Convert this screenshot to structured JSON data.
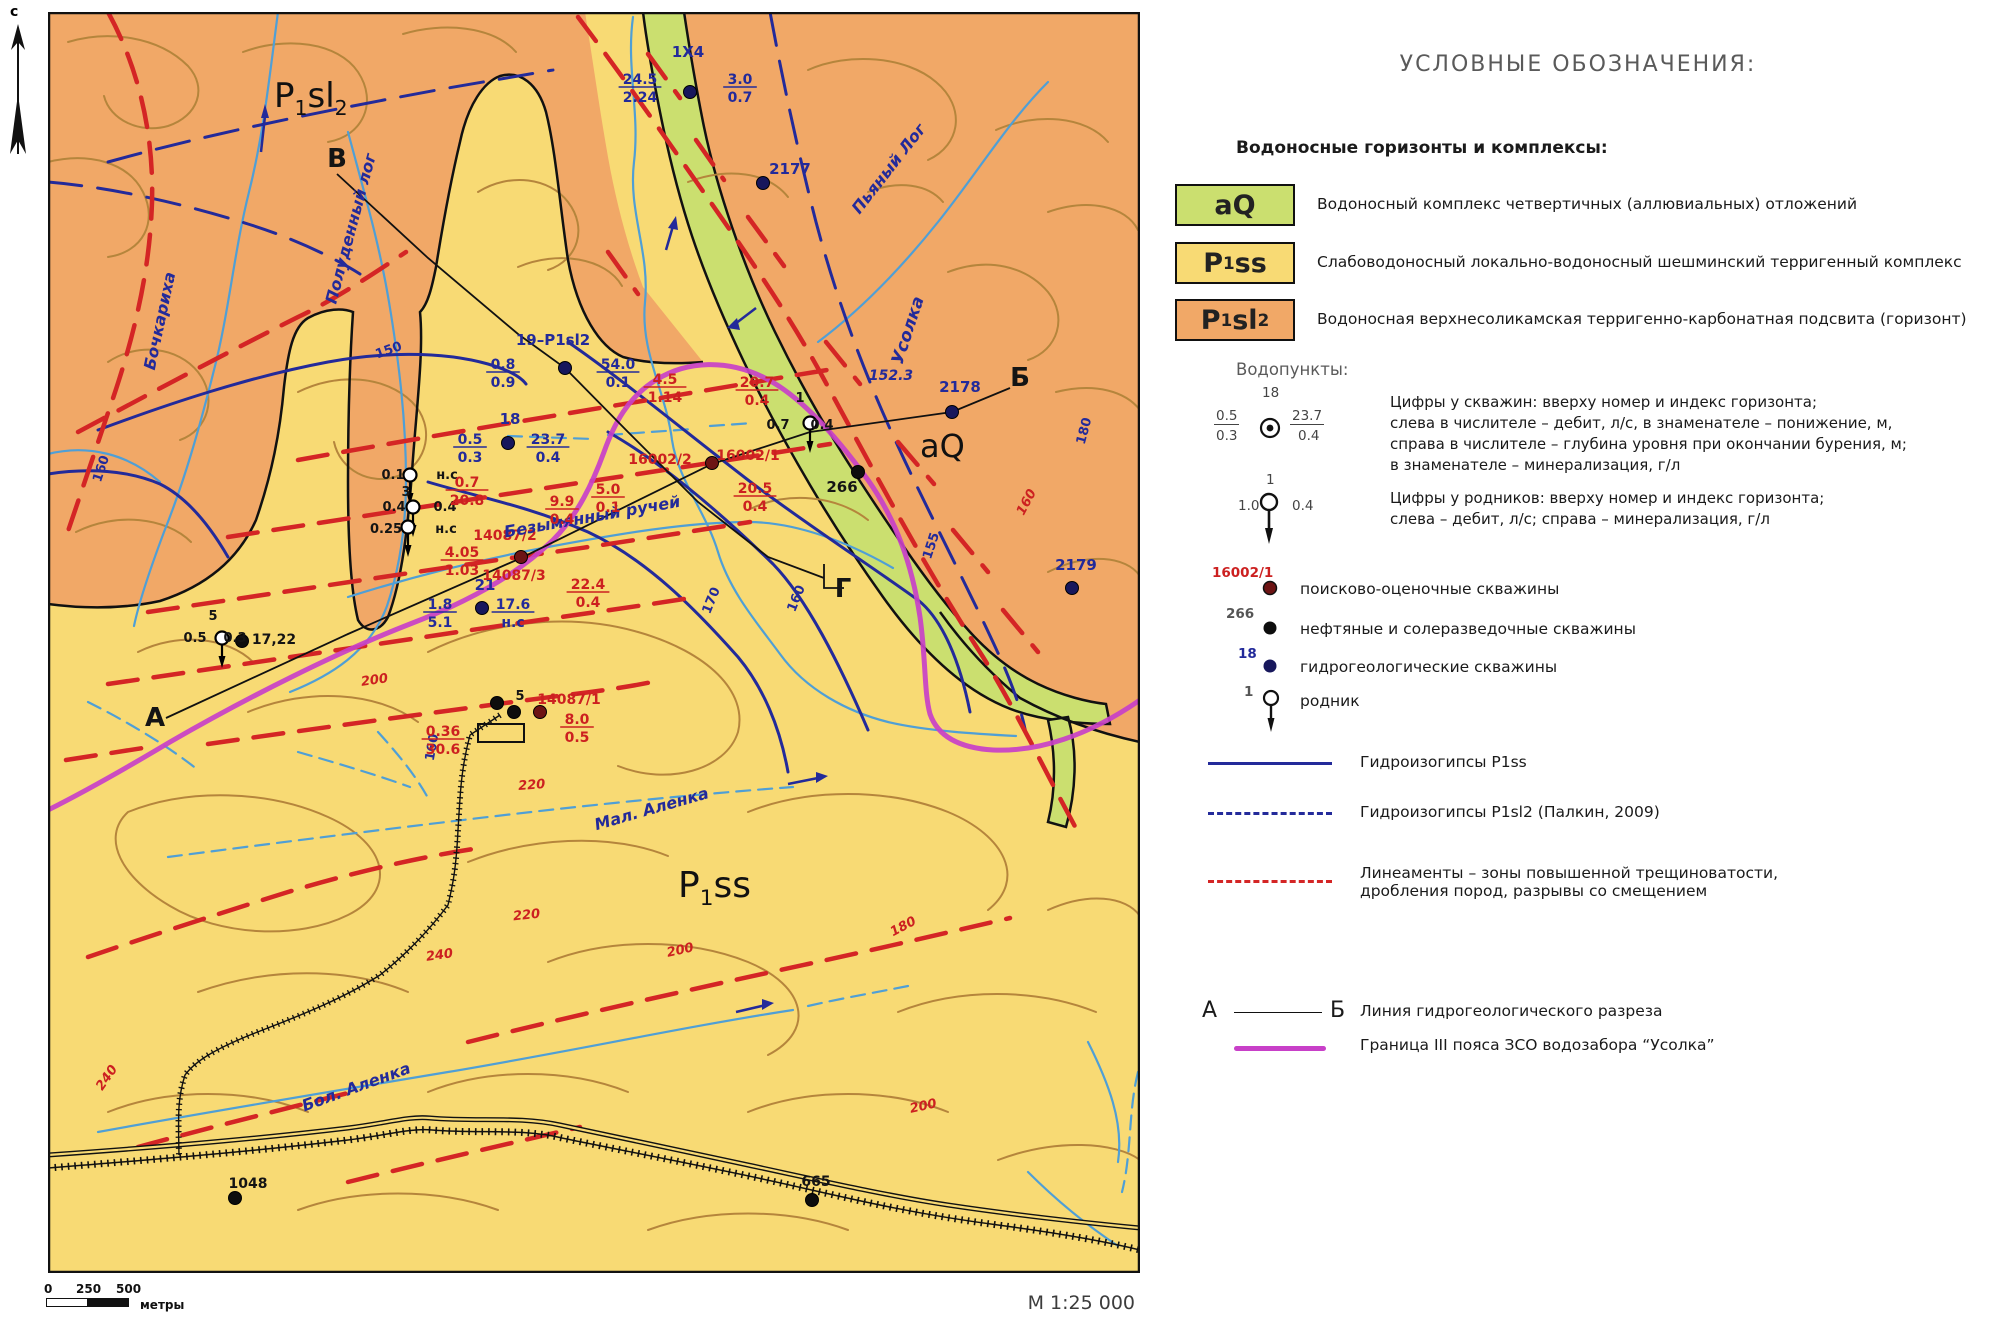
{
  "colors": {
    "aq": "#cbdf6f",
    "p1ss": "#f8da74",
    "p1sl2": "#f1a867",
    "contour": "#b5853c",
    "stream": "#4f9fd6",
    "navy": "#232a9a",
    "black": "#141414",
    "red": "#cc2020",
    "lineament": "#d42525",
    "boundary": "#c840c8",
    "gray": "#555555"
  },
  "page": {
    "north_label": "с",
    "scale_label": "М 1:25 000",
    "scalebar": {
      "t0": "0",
      "t1": "250",
      "t2": "500",
      "unit": "метры"
    }
  },
  "map": {
    "unit_labels": [
      {
        "x": 226,
        "y": 95,
        "size": 34,
        "parts": [
          {
            "t": "P"
          },
          {
            "t": "1",
            "sub": true
          },
          {
            "t": "sl"
          },
          {
            "t": "2",
            "sub": true
          }
        ]
      },
      {
        "x": 630,
        "y": 885,
        "size": 36,
        "parts": [
          {
            "t": "P"
          },
          {
            "t": "1",
            "sub": true
          },
          {
            "t": "ss"
          }
        ]
      },
      {
        "x": 872,
        "y": 445,
        "size": 32,
        "parts": [
          {
            "t": "aQ"
          }
        ]
      }
    ],
    "labels": [
      {
        "t": "1X4",
        "x": 640,
        "y": 45,
        "c": "navy",
        "s": 15
      },
      {
        "t": "2177",
        "x": 742,
        "y": 162,
        "c": "navy",
        "s": 15
      },
      {
        "t": "19–P1sl2",
        "x": 505,
        "y": 333,
        "c": "navy",
        "s": 15
      },
      {
        "t": "18",
        "x": 462,
        "y": 412,
        "c": "navy",
        "s": 15
      },
      {
        "t": "21",
        "x": 437,
        "y": 578,
        "c": "navy",
        "s": 15
      },
      {
        "t": "2178",
        "x": 912,
        "y": 380,
        "c": "navy",
        "s": 15
      },
      {
        "t": "2179",
        "x": 1028,
        "y": 558,
        "c": "navy",
        "s": 15
      },
      {
        "t": "152.3",
        "x": 843,
        "y": 368,
        "c": "navy",
        "s": 14,
        "i": true
      },
      {
        "t": "150",
        "x": 342,
        "y": 342,
        "c": "navy",
        "s": 13,
        "r": -20
      },
      {
        "t": "160",
        "x": 57,
        "y": 458,
        "c": "navy",
        "s": 13,
        "r": -72
      },
      {
        "t": "170",
        "x": 667,
        "y": 590,
        "c": "navy",
        "s": 13,
        "r": -68
      },
      {
        "t": "160",
        "x": 752,
        "y": 588,
        "c": "navy",
        "s": 13,
        "r": -68
      },
      {
        "t": "155",
        "x": 887,
        "y": 535,
        "c": "navy",
        "s": 13,
        "r": -72
      },
      {
        "t": "180",
        "x": 1040,
        "y": 420,
        "c": "navy",
        "s": 13,
        "r": -75
      },
      {
        "t": "160",
        "x": 388,
        "y": 736,
        "c": "navy",
        "s": 13,
        "r": -80
      },
      {
        "t": "266",
        "x": 794,
        "y": 480,
        "c": "black",
        "s": 15
      },
      {
        "t": "17,22",
        "x": 226,
        "y": 632,
        "c": "black",
        "s": 14
      },
      {
        "t": "1048",
        "x": 200,
        "y": 1176,
        "c": "black",
        "s": 14
      },
      {
        "t": "665",
        "x": 768,
        "y": 1174,
        "c": "black",
        "s": 14
      },
      {
        "t": "5",
        "x": 165,
        "y": 608,
        "c": "black",
        "s": 13
      },
      {
        "t": "5",
        "x": 472,
        "y": 688,
        "c": "black",
        "s": 13
      },
      {
        "t": "3",
        "x": 358,
        "y": 484,
        "c": "black",
        "s": 13
      },
      {
        "t": "0.1",
        "x": 345,
        "y": 467,
        "c": "black",
        "s": 13
      },
      {
        "t": "н.с",
        "x": 399,
        "y": 467,
        "c": "black",
        "s": 13
      },
      {
        "t": "0.4",
        "x": 346,
        "y": 499,
        "c": "black",
        "s": 13
      },
      {
        "t": "0.4",
        "x": 397,
        "y": 499,
        "c": "black",
        "s": 13
      },
      {
        "t": "0.25",
        "x": 338,
        "y": 521,
        "c": "black",
        "s": 13
      },
      {
        "t": "н.с",
        "x": 398,
        "y": 521,
        "c": "black",
        "s": 13
      },
      {
        "t": "0.5",
        "x": 147,
        "y": 630,
        "c": "black",
        "s": 13
      },
      {
        "t": "0.3",
        "x": 187,
        "y": 630,
        "c": "black",
        "s": 13
      },
      {
        "t": "1",
        "x": 752,
        "y": 390,
        "c": "black",
        "s": 13
      },
      {
        "t": "0.7",
        "x": 730,
        "y": 417,
        "c": "black",
        "s": 13
      },
      {
        "t": "0.4",
        "x": 774,
        "y": 417,
        "c": "black",
        "s": 13
      },
      {
        "t": "А",
        "x": 107,
        "y": 714,
        "c": "black",
        "s": 26
      },
      {
        "t": "Б",
        "x": 972,
        "y": 374,
        "c": "black",
        "s": 26
      },
      {
        "t": "В",
        "x": 289,
        "y": 155,
        "c": "black",
        "s": 26
      },
      {
        "t": "Г",
        "x": 795,
        "y": 585,
        "c": "black",
        "s": 26
      },
      {
        "t": "14087/2",
        "x": 457,
        "y": 528,
        "c": "red",
        "s": 14
      },
      {
        "t": "14087/3",
        "x": 466,
        "y": 568,
        "c": "red",
        "s": 14
      },
      {
        "t": "14087/1",
        "x": 521,
        "y": 692,
        "c": "red",
        "s": 14
      },
      {
        "t": "16002/2",
        "x": 612,
        "y": 452,
        "c": "red",
        "s": 14
      },
      {
        "t": "16002/1",
        "x": 700,
        "y": 448,
        "c": "red",
        "s": 14
      },
      {
        "t": "200",
        "x": 327,
        "y": 672,
        "c": "red",
        "s": 13,
        "r": -8,
        "i": true
      },
      {
        "t": "220",
        "x": 484,
        "y": 777,
        "c": "red",
        "s": 13,
        "r": -4,
        "i": true
      },
      {
        "t": "220",
        "x": 479,
        "y": 907,
        "c": "red",
        "s": 13,
        "r": -6,
        "i": true
      },
      {
        "t": "240",
        "x": 392,
        "y": 947,
        "c": "red",
        "s": 13,
        "r": -8,
        "i": true
      },
      {
        "t": "200",
        "x": 633,
        "y": 942,
        "c": "red",
        "s": 13,
        "r": -12,
        "i": true
      },
      {
        "t": "240",
        "x": 62,
        "y": 1068,
        "c": "red",
        "s": 13,
        "r": -55,
        "i": true
      },
      {
        "t": "180",
        "x": 857,
        "y": 918,
        "c": "red",
        "s": 13,
        "r": -28,
        "i": true
      },
      {
        "t": "200",
        "x": 876,
        "y": 1098,
        "c": "red",
        "s": 13,
        "r": -12,
        "i": true
      },
      {
        "t": "160",
        "x": 982,
        "y": 492,
        "c": "red",
        "s": 13,
        "r": -62,
        "i": true
      },
      {
        "t": "Бочкариха",
        "x": 117,
        "y": 310,
        "c": "navy",
        "s": 16,
        "r": -78,
        "i": true
      },
      {
        "t": "Полуденный лог",
        "x": 308,
        "y": 218,
        "c": "navy",
        "s": 16,
        "r": -75,
        "i": true
      },
      {
        "t": "Пьяный Лог",
        "x": 845,
        "y": 160,
        "c": "navy",
        "s": 16,
        "r": -52,
        "i": true
      },
      {
        "t": "Усолка",
        "x": 865,
        "y": 320,
        "c": "navy",
        "s": 17,
        "r": -72,
        "i": true
      },
      {
        "t": "Безымянный ручей",
        "x": 545,
        "y": 510,
        "c": "navy",
        "s": 16,
        "r": -10,
        "i": true
      },
      {
        "t": "Мал. Аленка",
        "x": 605,
        "y": 802,
        "c": "navy",
        "s": 16,
        "r": -16,
        "i": true
      },
      {
        "t": "Бол. Аленка",
        "x": 310,
        "y": 1080,
        "c": "navy",
        "s": 16,
        "r": -20,
        "i": true
      }
    ],
    "fractions": [
      {
        "n": "24.5",
        "d": "2.24",
        "x": 592,
        "y": 75,
        "c": "navy"
      },
      {
        "n": "3.0",
        "d": "0.7",
        "x": 692,
        "y": 75,
        "c": "navy"
      },
      {
        "n": "0.8",
        "d": "0.9",
        "x": 455,
        "y": 360,
        "c": "navy"
      },
      {
        "n": "54.0",
        "d": "0.1",
        "x": 570,
        "y": 360,
        "c": "navy"
      },
      {
        "n": "0.5",
        "d": "0.3",
        "x": 422,
        "y": 435,
        "c": "navy"
      },
      {
        "n": "23.7",
        "d": "0.4",
        "x": 500,
        "y": 435,
        "c": "navy"
      },
      {
        "n": "1.8",
        "d": "5.1",
        "x": 392,
        "y": 600,
        "c": "navy"
      },
      {
        "n": "17.6",
        "d": "н.с",
        "x": 465,
        "y": 600,
        "c": "navy"
      },
      {
        "n": "0.7",
        "d": "20.8",
        "x": 419,
        "y": 478,
        "c": "red"
      },
      {
        "n": "9.9",
        "d": "0.4",
        "x": 514,
        "y": 497,
        "c": "red"
      },
      {
        "n": "5.0",
        "d": "0.1",
        "x": 560,
        "y": 485,
        "c": "red"
      },
      {
        "n": "4.05",
        "d": "1.03",
        "x": 414,
        "y": 548,
        "c": "red"
      },
      {
        "n": "22.4",
        "d": "0.4",
        "x": 540,
        "y": 580,
        "c": "red"
      },
      {
        "n": "4.5",
        "d": "1.14",
        "x": 617,
        "y": 375,
        "c": "red"
      },
      {
        "n": "20.7",
        "d": "0.4",
        "x": 709,
        "y": 378,
        "c": "red"
      },
      {
        "n": "20.5",
        "d": "0.4",
        "x": 707,
        "y": 484,
        "c": "red"
      },
      {
        "n": "8.0",
        "d": "0.5",
        "x": 529,
        "y": 715,
        "c": "red"
      },
      {
        "n": "0.36",
        "d": "30.6",
        "x": 395,
        "y": 727,
        "c": "red"
      }
    ],
    "wells": [
      {
        "x": 642,
        "y": 80,
        "k": "hydro"
      },
      {
        "x": 715,
        "y": 171,
        "k": "hydro"
      },
      {
        "x": 904,
        "y": 400,
        "k": "hydro"
      },
      {
        "x": 1024,
        "y": 576,
        "k": "hydro"
      },
      {
        "x": 517,
        "y": 356,
        "k": "hydro"
      },
      {
        "x": 460,
        "y": 431,
        "k": "hydro"
      },
      {
        "x": 434,
        "y": 596,
        "k": "hydro"
      },
      {
        "x": 810,
        "y": 460,
        "k": "oil"
      },
      {
        "x": 194,
        "y": 629,
        "k": "oil"
      },
      {
        "x": 187,
        "y": 1186,
        "k": "oil"
      },
      {
        "x": 764,
        "y": 1188,
        "k": "oil"
      },
      {
        "x": 449,
        "y": 691,
        "k": "oil"
      },
      {
        "x": 466,
        "y": 700,
        "k": "oil"
      },
      {
        "x": 664,
        "y": 451,
        "k": "search"
      },
      {
        "x": 473,
        "y": 545,
        "k": "search"
      },
      {
        "x": 492,
        "y": 700,
        "k": "search"
      }
    ],
    "springs": [
      {
        "x": 362,
        "y": 463
      },
      {
        "x": 365,
        "y": 495
      },
      {
        "x": 360,
        "y": 515
      },
      {
        "x": 174,
        "y": 626
      },
      {
        "x": 762,
        "y": 411
      }
    ]
  },
  "legend": {
    "title": "УСЛОВНЫЕ ОБОЗНАЧЕНИЯ:",
    "aquifers_heading": "Водоносные горизонты и комплексы:",
    "aquifers": [
      {
        "code": [
          {
            "t": "aQ"
          }
        ],
        "color": "#cbdf6f",
        "label": "Водоносный комплекс четвертичных (аллювиальных) отложений"
      },
      {
        "code": [
          {
            "t": "P"
          },
          {
            "t": "1",
            "sub": true
          },
          {
            "t": "ss"
          }
        ],
        "color": "#f8da74",
        "label": "Слабоводоносный локально-водоносный шешминский терригенный комплекс"
      },
      {
        "code": [
          {
            "t": "P"
          },
          {
            "t": "1",
            "sub": true
          },
          {
            "t": "sl"
          },
          {
            "t": "2",
            "sub": true
          }
        ],
        "color": "#f1a867",
        "label": "Водоносная верхнесоликамская терригенно-карбонатная подсвита (горизонт)"
      }
    ],
    "waterpoints_heading": "Водопункты:",
    "well_diagram": {
      "top": "18",
      "left_num": "0.5",
      "left_den": "0.3",
      "right_num": "23.7",
      "right_den": "0.4",
      "desc": [
        "Цифры у скважин: вверху номер и индекс горизонта;",
        "слева в числителе – дебит, л/с, в знаменателе – понижение, м,",
        "справа в числителе – глубина уровня при окончании бурения, м;",
        "в знаменателе – минерализация, г/л"
      ]
    },
    "spring_diagram": {
      "top": "1",
      "left": "1.0",
      "right": "0.4",
      "desc": [
        "Цифры у родников: вверху номер и индекс горизонта;",
        "слева – дебит, л/с; справа – минерализация, г/л"
      ]
    },
    "well_types": [
      {
        "tag": "16002/1",
        "tag_color": "#cc2020",
        "label": "поисково-оценочные скважины"
      },
      {
        "tag": "266",
        "tag_color": "#555555",
        "label": "нефтяные и солеразведочные скважины"
      },
      {
        "tag": "18",
        "tag_color": "#232a9a",
        "label": "гидрогеологические скважины"
      },
      {
        "tag": "1",
        "tag_color": "#555555",
        "label": "родник"
      }
    ],
    "lines": [
      {
        "label": "Гидроизогипсы P1ss"
      },
      {
        "label": "Гидроизогипсы P1sl2 (Палкин, 2009)"
      },
      {
        "label": "Линеаменты – зоны повышенной трещиноватости,",
        "label2": "дробления пород, разрывы со смещением"
      }
    ],
    "section": {
      "a": "А",
      "b": "Б",
      "label": "Линия гидрогеологического разреза"
    },
    "boundary": {
      "label": "Граница III пояса ЗСО водозабора “Усолка”"
    }
  }
}
